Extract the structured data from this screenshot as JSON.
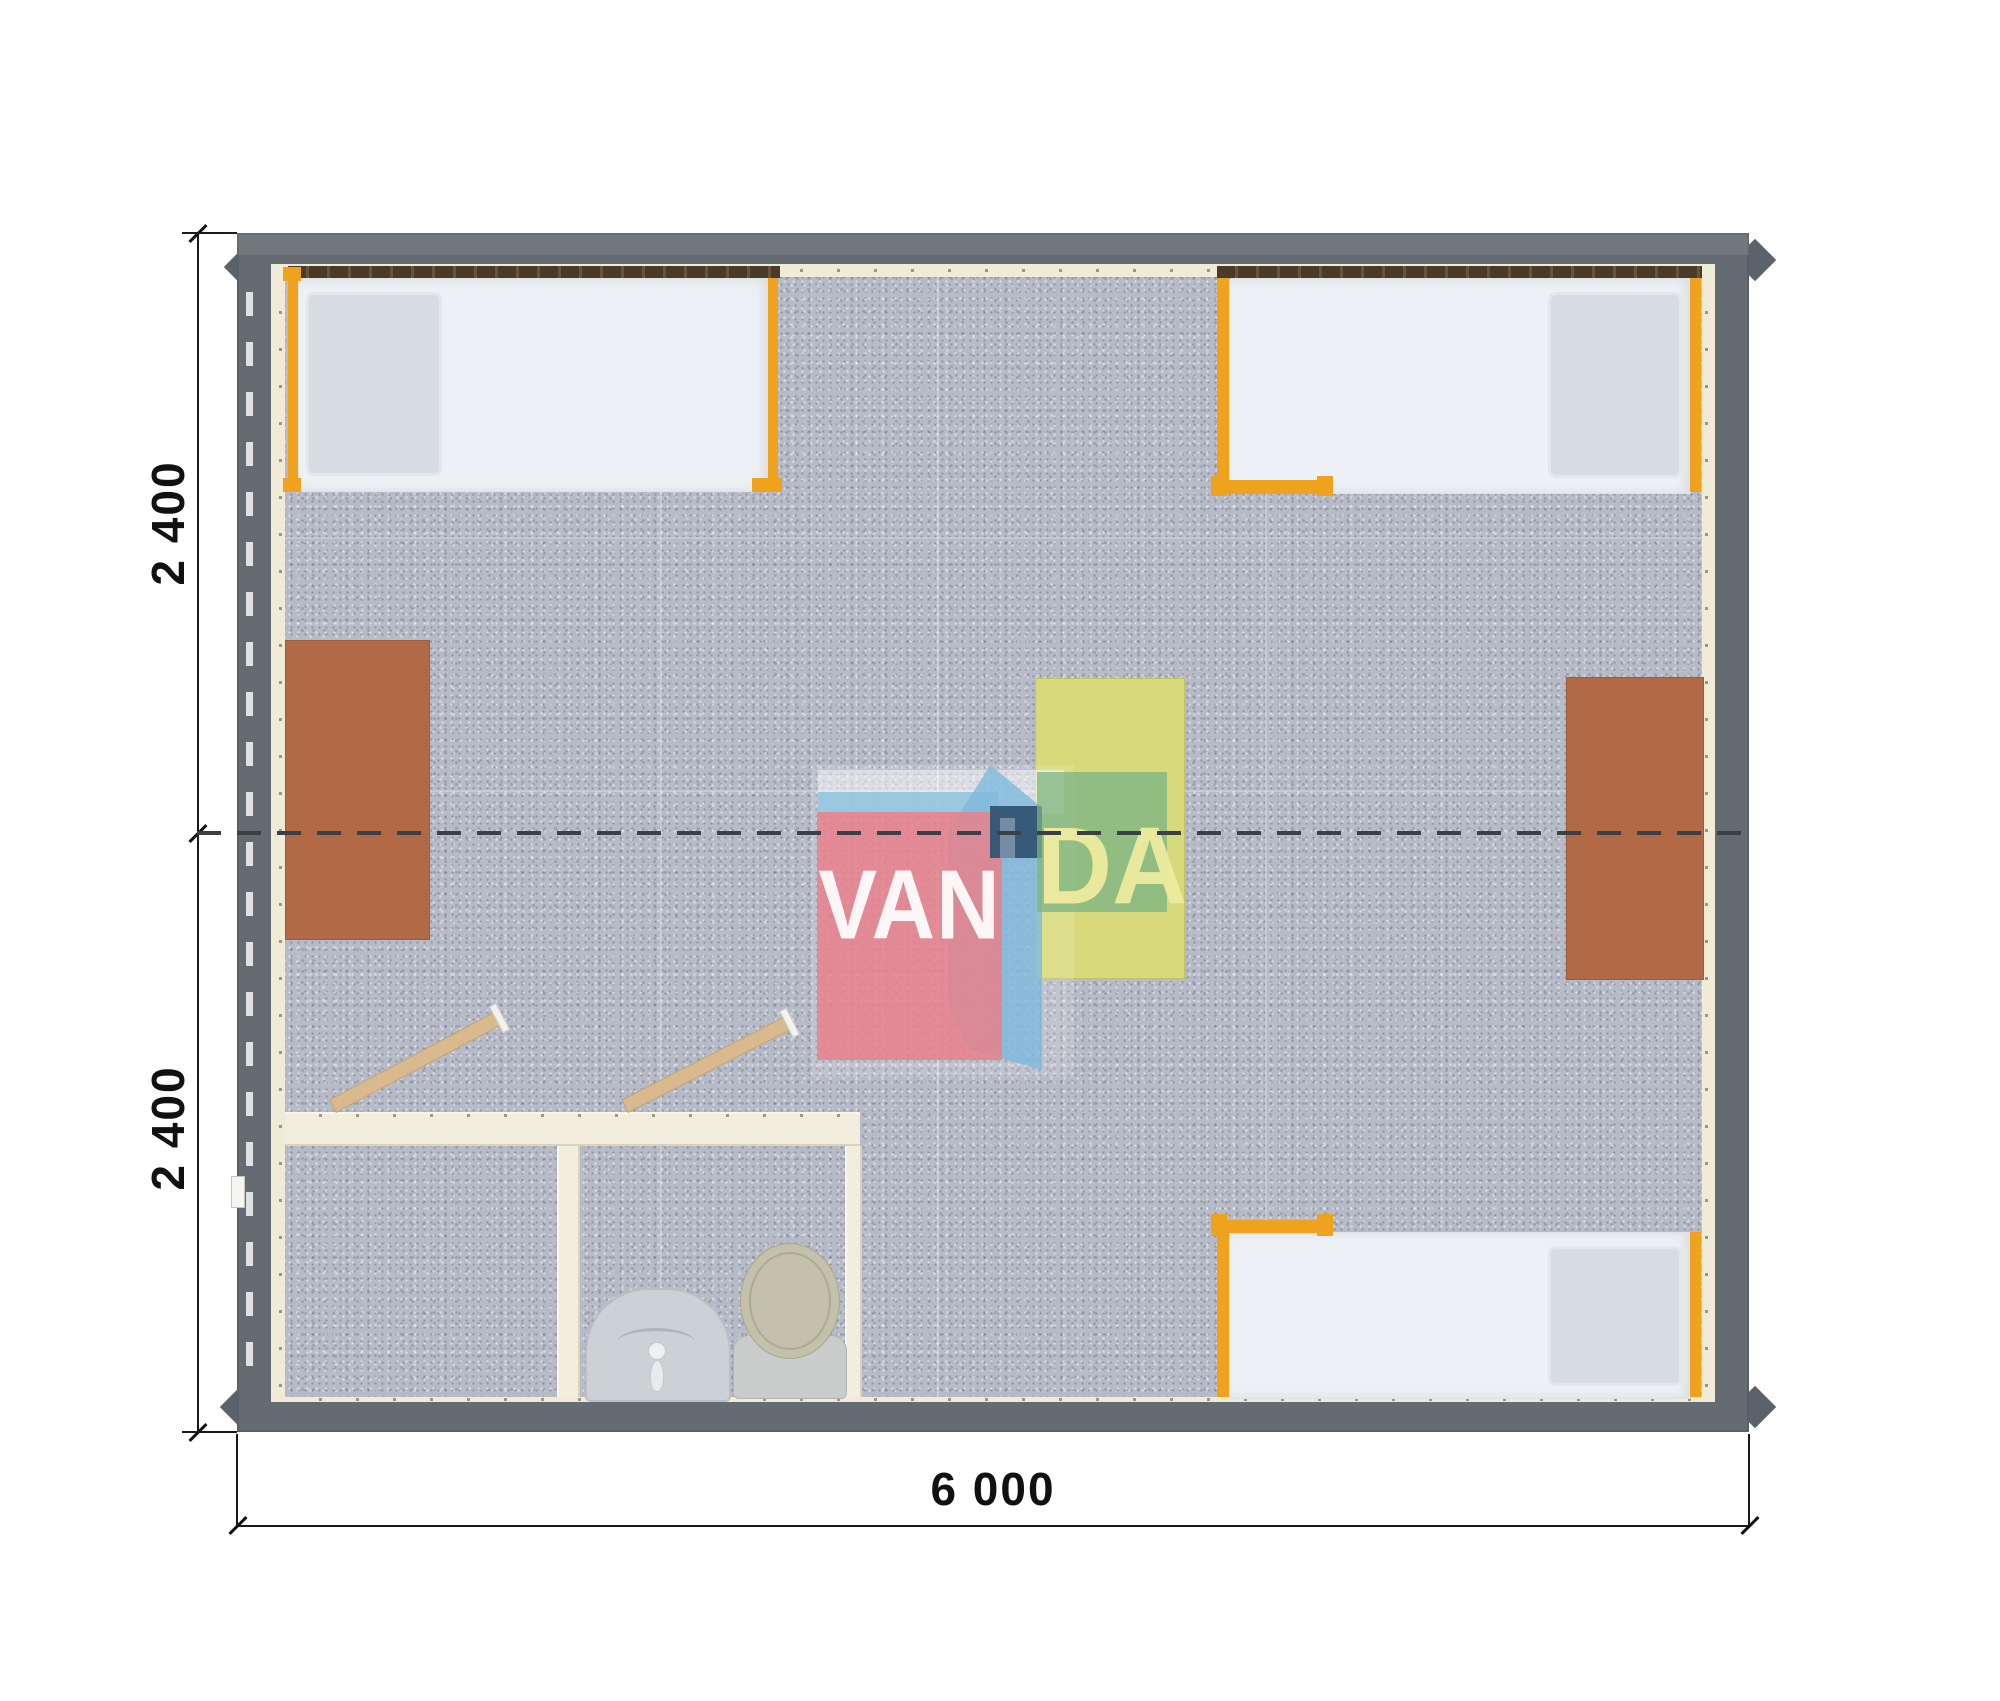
{
  "scene": {
    "type": "floor-plan-render",
    "background": "#ffffff",
    "description": "Top view render of a 6000 x 4800 mm modular cabin with three beds, two desks, center table and bathroom block"
  },
  "dimensions": {
    "left_top_label": "2 400",
    "left_bottom_label": "2 400",
    "bottom_label": "6 000"
  },
  "watermark": {
    "text_left": "VAN",
    "text_right": "DA",
    "colors": {
      "red_box": "#e8808b",
      "blue_shape": "#8fc3e0",
      "navy_square": "#325473",
      "green_box": "#7ab387",
      "text_left_color": "#ffffff",
      "text_right_color": "#eeeb9e"
    }
  },
  "palette": {
    "wall_outer": "#656b72",
    "wall_lining": "#f0ebd7",
    "floor": "#b7bbc7",
    "bed_mattress": "#edf0f4",
    "bed_pillow": "#d7dce1",
    "bed_frame_orange": "#efa21d",
    "window_rail_brown": "#4a3a29",
    "desk_brown": "#b16a45",
    "table_yellow": "#d8d97a",
    "bathroom_wall": "#f2eddc",
    "door_wood": "#d9ba8e",
    "toilet": "#c3c1ab",
    "sink": "#ccd1d5",
    "centerline": "#3b4046",
    "dimension_ink": "#1a1a1a"
  },
  "furniture": {
    "beds": [
      {
        "name": "bed-top-left",
        "pillow_side": "left"
      },
      {
        "name": "bed-top-right",
        "pillow_side": "right"
      },
      {
        "name": "bed-bottom-right",
        "pillow_side": "right"
      }
    ],
    "tables": [
      {
        "name": "desk-left",
        "color": "brown"
      },
      {
        "name": "desk-right",
        "color": "brown"
      },
      {
        "name": "table-center",
        "color": "yellow"
      }
    ],
    "bathroom": {
      "rooms": [
        "shower-room",
        "wc-room"
      ],
      "fixtures": [
        "washbasin",
        "toilet"
      ],
      "doors_open": 2
    }
  }
}
